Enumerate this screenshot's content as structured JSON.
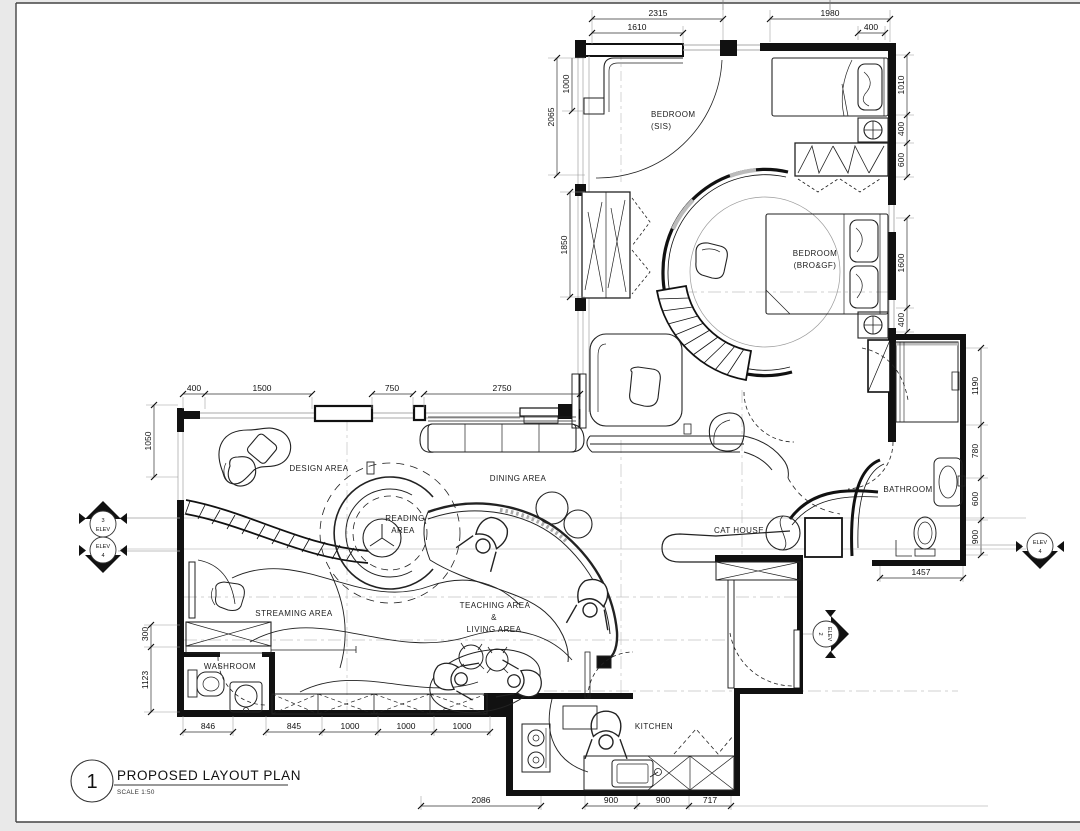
{
  "page": {
    "sheet_color": "#ffffff",
    "margin_color": "#e9e9e9",
    "ink_color": "#1a1a1a"
  },
  "title_block": {
    "number": "1",
    "title": "PROPOSED LAYOUT PLAN",
    "scale_label": "SCALE 1:50"
  },
  "rooms": {
    "bedroom_sis": [
      "BEDROOM",
      "(SIS)"
    ],
    "bedroom_bro": [
      "BEDROOM",
      "(BRO&GF)"
    ],
    "design": "DESIGN AREA",
    "reading": [
      "READING",
      "AREA"
    ],
    "dining": "DINING AREA",
    "cat_house": "CAT HOUSE",
    "bathroom": "BATHROOM",
    "streaming": "STREAMING AREA",
    "teaching": [
      "TEACHING AREA",
      "&",
      "LIVING AREA"
    ],
    "washroom": "WASHROOM",
    "kitchen": "KITCHEN"
  },
  "dimensions": {
    "top": [
      "2315",
      "1610",
      "1980",
      "400"
    ],
    "right_upper": [
      "1010",
      "400",
      "600",
      "1600",
      "400"
    ],
    "right_lower": [
      "1190",
      "780",
      "600",
      "900"
    ],
    "left_upper": [
      "1000",
      "2065",
      "1850"
    ],
    "mid_top": [
      "400",
      "1500",
      "750",
      "2750"
    ],
    "left_mid": [
      "1050",
      "300",
      "1123"
    ],
    "bottom_row1": [
      "846",
      "845",
      "1000",
      "1000",
      "1000"
    ],
    "bottom_row2": [
      "2086",
      "900",
      "900",
      "717"
    ],
    "bath_bottom": [
      "1457"
    ]
  },
  "elev": {
    "left_top": [
      "3",
      "ELEV"
    ],
    "left_bottom": [
      "ELEV",
      "4"
    ],
    "right": [
      "ELEV",
      "4"
    ],
    "corridor": [
      "ELEV",
      "2"
    ]
  }
}
